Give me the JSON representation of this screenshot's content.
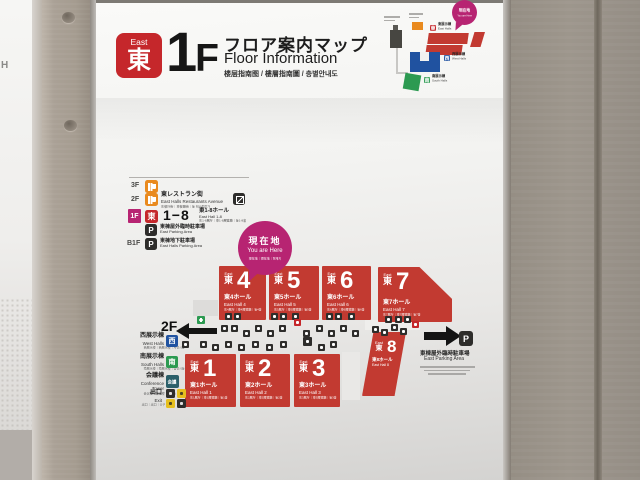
{
  "colors": {
    "brand_red": "#c5272b",
    "hall_red": "#c23a31",
    "magenta": "#b72472",
    "orange": "#e98a1e",
    "blue": "#2052a0",
    "green": "#2c9a51",
    "teal": "#2b5f69",
    "yellow": "#e6bf1e",
    "dark": "#2e2d2b"
  },
  "photo": {
    "adjacent_sign_text": "H"
  },
  "header": {
    "badge_en": "East",
    "badge_ja": "東",
    "floor_digit": "1",
    "floor_letter": "F",
    "title_ja": "フロア案内マップ",
    "title_en": "Floor Information",
    "title_multi": "楼层指南图 / 樓層指南圖 / 층별안내도"
  },
  "minimap": {
    "yah_ja": "現在地",
    "yah_en": "You are Here",
    "east_icon": "東",
    "east_ja": "東展示棟",
    "east_en": "East Halls",
    "west_icon": "西",
    "west_ja": "西展示棟",
    "west_en": "West Halls",
    "south_icon": "南",
    "south_ja": "南展示棟",
    "south_en": "South Halls"
  },
  "legend": {
    "floor3_label": "3F",
    "floor2_label": "2F",
    "floor2_ja": "東レストラン街",
    "floor2_en": "East Halls Restaurants Avenue",
    "floor2_multi": "东餐厅街｜東餐廳街｜동 레스토랑가",
    "floor1_label": "1F",
    "floor1_icon": "東",
    "floor1_range": "1−8",
    "floor1_ja": "東1-8ホール",
    "floor1_en": "East Hall 1-8",
    "floor1_multi": "东1-8展厅｜東1-8展覽廳｜동1-8홀",
    "parking_icon": "P",
    "floor1_parking_ja": "東棟屋外臨時駐車場",
    "floor1_parking_en": "East Parking Area",
    "floorb1_label": "B1F",
    "floorb1_ja": "東棟地下駐車場",
    "floorb1_en": "East Halls Parking Area"
  },
  "you_are_here": {
    "ja": "現在地",
    "en": "You are Here",
    "multi": "现在地｜現在地｜현재지"
  },
  "map": {
    "floor2_label": "2F",
    "halls": [
      {
        "en": "East",
        "ja": "東",
        "number": "4",
        "name_ja": "東4ホール",
        "name_en": "East Hall 4",
        "multi": "东4展厅｜東4展覽廳｜동4홀"
      },
      {
        "en": "East",
        "ja": "東",
        "number": "5",
        "name_ja": "東5ホール",
        "name_en": "East Hall 5",
        "multi": "东5展厅｜東5展覽廳｜동5홀"
      },
      {
        "en": "East",
        "ja": "東",
        "number": "6",
        "name_ja": "東6ホール",
        "name_en": "East Hall 6",
        "multi": "东6展厅｜東6展覽廳｜동6홀"
      },
      {
        "en": "East",
        "ja": "東",
        "number": "7",
        "name_ja": "東7ホール",
        "name_en": "East Hall 7",
        "multi": "东7展厅｜東7展覽廳｜동7홀"
      },
      {
        "en": "East",
        "ja": "東",
        "number": "1",
        "name_ja": "東1ホール",
        "name_en": "East Hall 1",
        "multi": "东1展厅｜東1展覽廳｜동1홀"
      },
      {
        "en": "East",
        "ja": "東",
        "number": "2",
        "name_ja": "東2ホール",
        "name_en": "East Hall 2",
        "multi": "东2展厅｜東2展覽廳｜동2홀"
      },
      {
        "en": "East",
        "ja": "東",
        "number": "3",
        "name_ja": "東3ホール",
        "name_en": "East Hall 3",
        "multi": "东3展厅｜東3展覽廳｜동3홀"
      },
      {
        "en": "East",
        "ja": "東",
        "number": "8",
        "name_ja": "東8ホール",
        "name_en": "East Hall 8",
        "multi": "东8展厅｜東8展覽廳｜동8홀"
      }
    ],
    "parking_icon": "P",
    "parking_ja": "東棟屋外臨時駐車場",
    "parking_en": "East Parking Area",
    "west_icon": "西",
    "west_ja": "西展示棟",
    "west_en": "West Halls",
    "west_multi": "西展示楼｜西展示樓｜서전시동",
    "south_icon": "南",
    "south_ja": "南展示棟",
    "south_en": "South Halls",
    "south_multi": "南展示楼｜南展示樓｜남전시동",
    "conference_icon": "会議",
    "conference_ja": "会議棟",
    "conference_en": "Conference Tower",
    "conference_multi": "会议楼｜會議樓｜회의동",
    "exit_ja": "出口",
    "exit_en": "Exit",
    "exit_multi": "出口｜出口｜출구"
  }
}
